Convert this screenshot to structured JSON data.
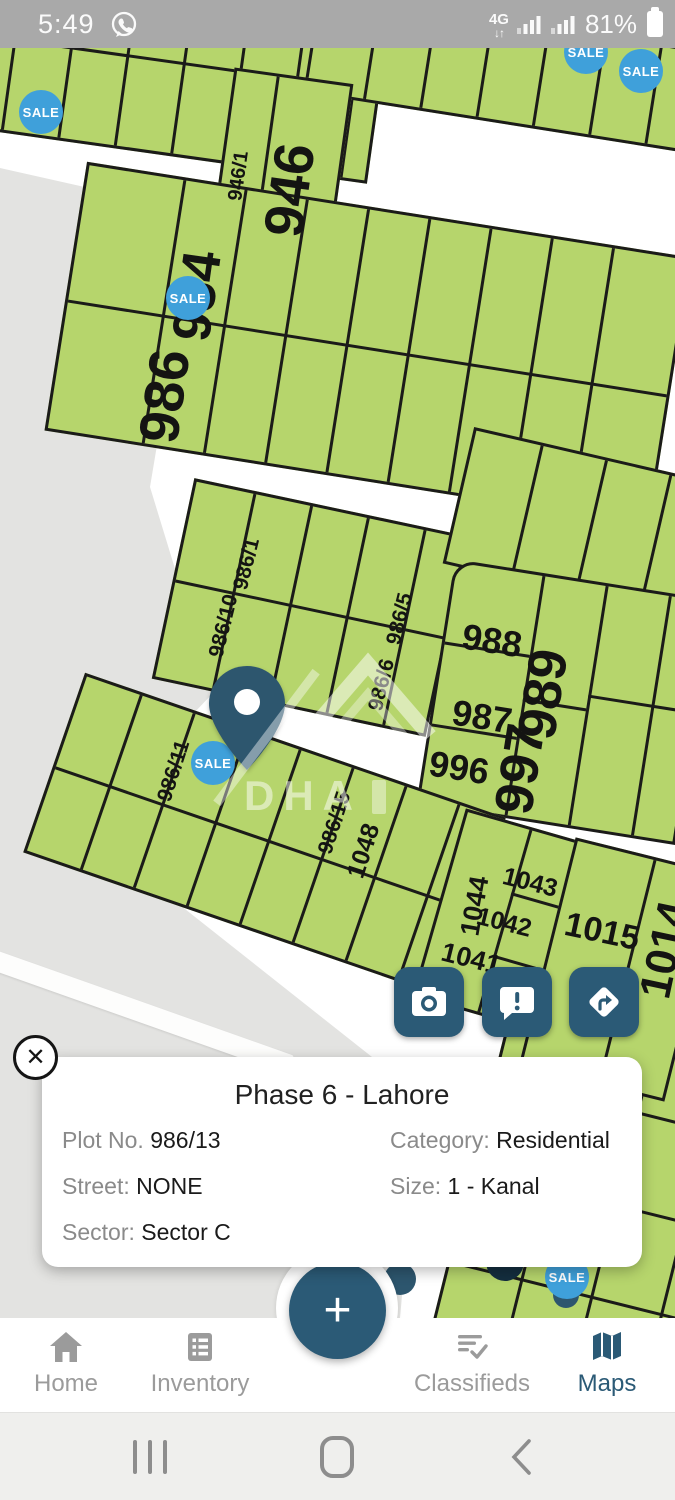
{
  "status_bar": {
    "time": "5:49",
    "network_type": "4G",
    "battery_percent": "81%"
  },
  "map": {
    "title_hidden": "",
    "sale_badge_label": "SALE",
    "watermark_text": "DHA",
    "plot_labels": [
      {
        "text": "946/1"
      },
      {
        "text": "946"
      },
      {
        "text": "954"
      },
      {
        "text": "986"
      },
      {
        "text": "986/1"
      },
      {
        "text": "986/10"
      },
      {
        "text": "986/5"
      },
      {
        "text": "986/6"
      },
      {
        "text": "988"
      },
      {
        "text": "989"
      },
      {
        "text": "987"
      },
      {
        "text": "996"
      },
      {
        "text": "997"
      },
      {
        "text": "986/11"
      },
      {
        "text": "986/15"
      },
      {
        "text": "1048"
      },
      {
        "text": "1044"
      },
      {
        "text": "1043"
      },
      {
        "text": "1042"
      },
      {
        "text": "1041"
      },
      {
        "text": "1015"
      },
      {
        "text": "1014"
      }
    ],
    "icons": [
      "camera-icon",
      "feedback-icon",
      "directions-icon",
      "location-pin-icon"
    ]
  },
  "info_card": {
    "title": "Phase 6 - Lahore",
    "close_glyph": "✕",
    "fields": [
      {
        "label": "Plot No.",
        "value": "986/13"
      },
      {
        "label": "Category:",
        "value": "Residential"
      },
      {
        "label": "Street:",
        "value": "NONE"
      },
      {
        "label": "Size:",
        "value": "1 - Kanal"
      },
      {
        "label": "Sector:",
        "value": "Sector C"
      }
    ]
  },
  "fab": {
    "label": "+"
  },
  "bottom_nav": {
    "active": "Maps",
    "items": [
      {
        "label": "Home"
      },
      {
        "label": "Inventory"
      },
      {
        "label": "Classifieds"
      },
      {
        "label": "Maps"
      }
    ]
  },
  "colors": {
    "accent_teal": "#2b5a76",
    "sale_blue": "#3fa0da",
    "plot_green": "#b6d56c",
    "plot_border": "#1b1b19",
    "map_gray": "#e3e3e1",
    "status_gray": "#a9a9a9"
  }
}
